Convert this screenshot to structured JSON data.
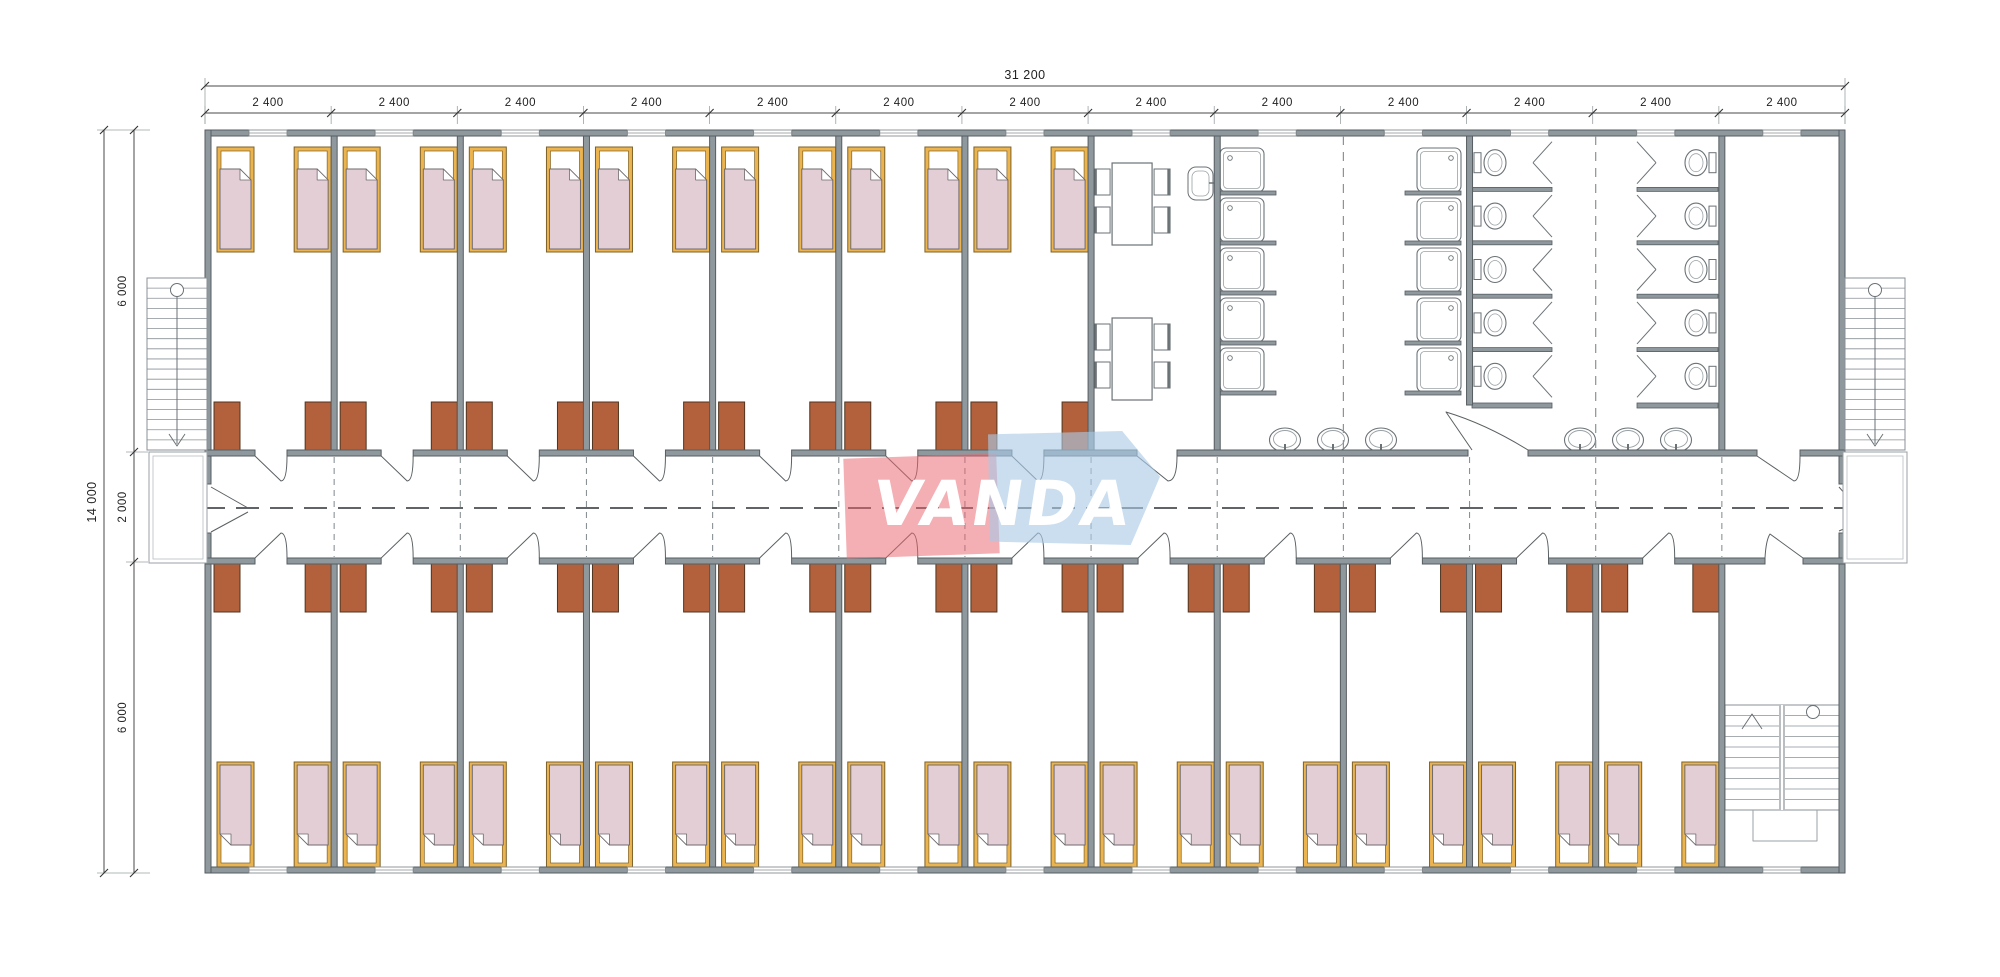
{
  "logo": {
    "text": "VANDA",
    "red_color": "#e8656d",
    "blue_color": "#a9c9e6",
    "text_color": "#ffffff"
  },
  "dimensions": {
    "top_total_label": "31 200",
    "module_labels": [
      "2 400",
      "2 400",
      "2 400",
      "2 400",
      "2 400",
      "2 400",
      "2 400",
      "2 400",
      "2 400",
      "2 400",
      "2 400",
      "2 400",
      "2 400"
    ],
    "left_total_label": "14 000",
    "left_section_labels": [
      "6 000",
      "2 000",
      "6 000"
    ]
  },
  "plan": {
    "colors": {
      "wall_fill": "#8f989d",
      "wall_edge": "#565e62",
      "dim_line": "#4a4a4a",
      "dim_text": "#222222",
      "ext_line": "#9aa1a4",
      "fixture_line": "#6a7276",
      "fixture_light": "#9aa1a4",
      "bed_frame": "#ecb44f",
      "bed_frame_edge": "#7d6128",
      "blanket": "#e3ced6",
      "blanket_edge": "#6f6a6d",
      "wardrobe": "#b2613c",
      "wardrobe_edge": "#50341f",
      "centerline": "#4a4e50",
      "joint_dash": "#8a9296",
      "window_line": "#888e91"
    },
    "counts": {
      "top_bedrooms": 7,
      "bottom_bedrooms": 12,
      "beds_per_bedroom": 2,
      "wardrobes_per_bedroom": 2,
      "dining_tables": 2,
      "chairs_per_table": 4,
      "canteen_sinks": 1,
      "shower_columns": 2,
      "showers_per_column": 5,
      "toilet_columns": 2,
      "toilets_per_column": 5,
      "washbasin_groups": 2,
      "washbasins_per_group": 3,
      "external_staircases": 2,
      "internal_staircases": 1,
      "modules_total": 13
    }
  }
}
